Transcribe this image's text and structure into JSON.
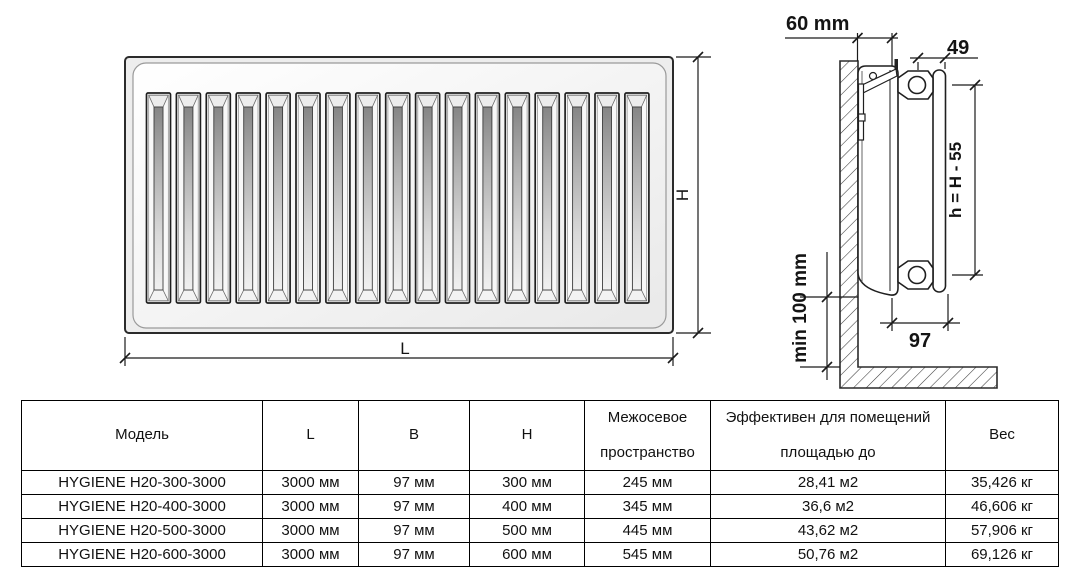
{
  "front_view": {
    "height_label": "H",
    "length_label": "L",
    "slot_count": 17
  },
  "side_view": {
    "wall_offset_label": "60 mm",
    "axis_spacing_label": "49",
    "mount_height_label": "h = H - 55",
    "floor_clearance_label": "min 100 mm",
    "depth_label": "97"
  },
  "table": {
    "headers": [
      "Модель",
      "L",
      "B",
      "H",
      "Межосевое пространство",
      "Эффективен для помещений площадью до",
      "Вес"
    ],
    "rows": [
      [
        "HYGIENE H20-300-3000",
        "3000 мм",
        "97 мм",
        "300 мм",
        "245 мм",
        "28,41 м2",
        "35,426 кг"
      ],
      [
        "HYGIENE H20-400-3000",
        "3000 мм",
        "97 мм",
        "400 мм",
        "345 мм",
        "36,6 м2",
        "46,606 кг"
      ],
      [
        "HYGIENE H20-500-3000",
        "3000 мм",
        "97 мм",
        "500 мм",
        "445 мм",
        "43,62 м2",
        "57,906 кг"
      ],
      [
        "HYGIENE H20-600-3000",
        "3000 мм",
        "97 мм",
        "600 мм",
        "545 мм",
        "50,76 м2",
        "69,126 кг"
      ]
    ]
  },
  "colors": {
    "line": "#1a1a1a",
    "table_border": "#000000",
    "slot_shadow": "#878787",
    "body_fill": "#f5f5f5"
  }
}
